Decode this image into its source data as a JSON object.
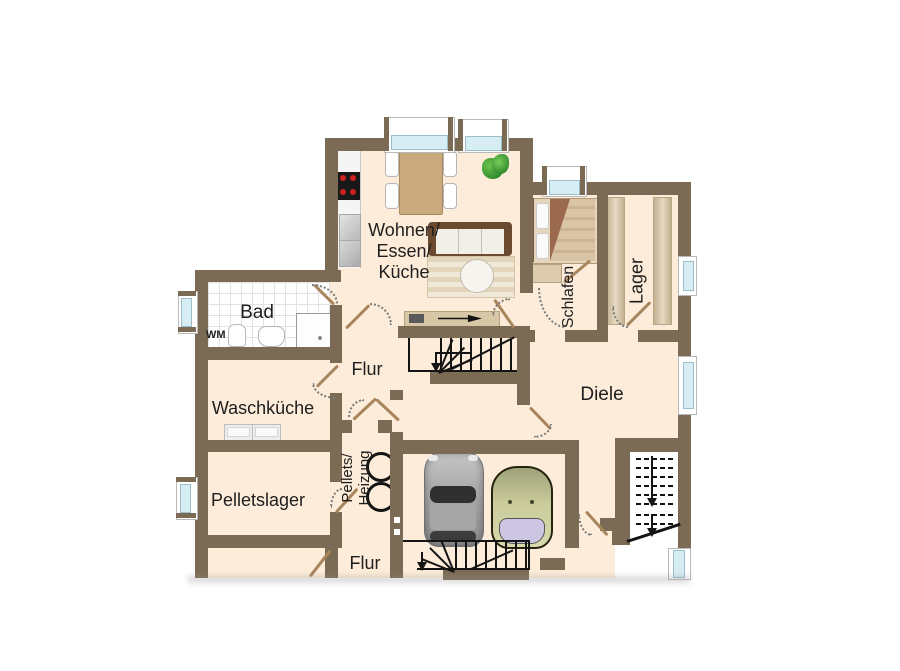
{
  "plan_type": "floorplan",
  "rooms": {
    "wohnen": {
      "line1": "Wohnen/",
      "line2": "Essen/",
      "line3": "Küche"
    },
    "schlafen": {
      "label": "Schlafen"
    },
    "lager": {
      "label": "Lager"
    },
    "bad": {
      "label": "Bad"
    },
    "wm": {
      "label": "WM"
    },
    "flur_mitte": {
      "label": "Flur"
    },
    "waschkueche": {
      "label": "Waschküche"
    },
    "pelletslager": {
      "label": "Pelletslager"
    },
    "pellets_heizung": {
      "line1": "Pellets/",
      "line2": "Heizung"
    },
    "diele": {
      "label": "Diele"
    },
    "flur_unten": {
      "label": "Flur"
    }
  },
  "colors": {
    "wall": "#7b6b54",
    "floor": "#fcecd9",
    "tile_line": "#dedede",
    "window_glass": "#d6edf4",
    "door_leaf": "#a8855c",
    "wood": "#c9a97e",
    "sofa": "#6b4a30",
    "bed_blanket": "#9b6a4e",
    "stair_line": "#141414",
    "car_gray": "#9f9f9f",
    "car_green": "#cdd0a0",
    "plant_green": "#3f9a34",
    "stove_burner": "#cf2020"
  }
}
